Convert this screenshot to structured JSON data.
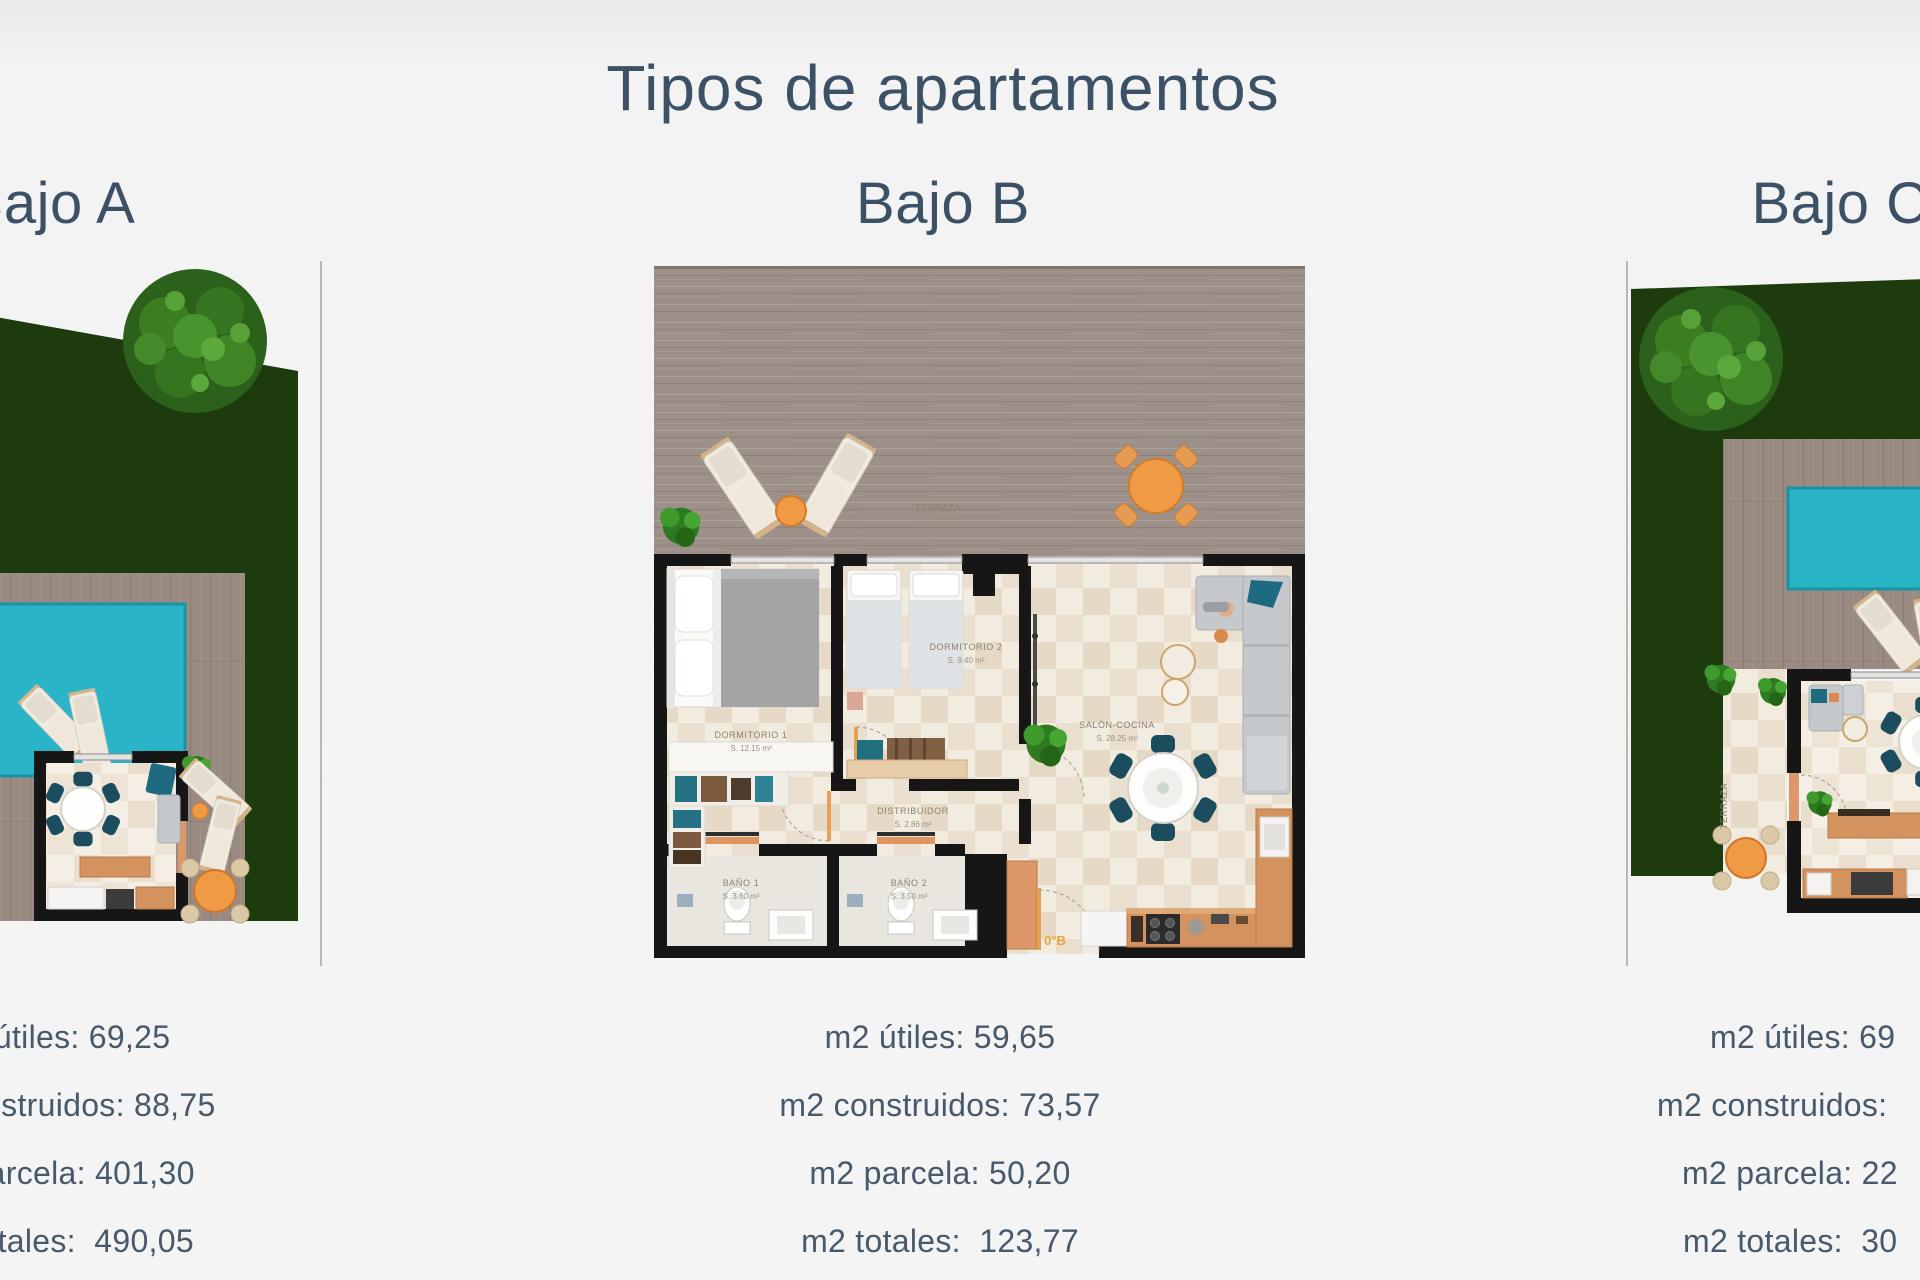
{
  "page": {
    "title": "Tipos de apartamentos"
  },
  "apartments": [
    {
      "id": "bajo-a",
      "title": "Bajo A",
      "stats": [
        "m2 útiles: 69,25",
        "m2 construidos: 88,75",
        "m2 parcela: 401,30",
        "m2 totales:  490,05"
      ]
    },
    {
      "id": "bajo-b",
      "title": "Bajo B",
      "stats": [
        "m2 útiles: 59,65",
        "m2 construidos: 73,57",
        "m2 parcela: 50,20",
        "m2 totales:  123,77"
      ],
      "plan_labels": {
        "terraza": "TERRAZA",
        "terraza_area": "S. 10.20 m²",
        "dormitorio1": "DORMITORIO 1",
        "dormitorio1_area": "S. 12.15 m²",
        "dormitorio2": "DORMITORIO 2",
        "dormitorio2_area": "S. 9.40 m²",
        "salon": "SALÓN-COCINA",
        "salon_area": "S. 28.25 m²",
        "distribuidor": "DISTRIBUIDOR",
        "distribuidor_area": "S. 2.86 m²",
        "bano1": "BAÑO 1",
        "bano1_area": "S. 3.60 m²",
        "bano2": "BAÑO 2",
        "bano2_area": "S. 3.50 m²",
        "puerta": "0°B"
      }
    },
    {
      "id": "bajo-c",
      "title": "Bajo C",
      "stats_visible": [
        "m2 útiles: 69",
        "m2 construidos:",
        "m2 parcela: 22",
        "m2 totales:  30"
      ],
      "plan_labels": {
        "terraza": "TERRAZA"
      }
    }
  ],
  "colors": {
    "heading_text": "#3d5166",
    "stats_text": "#48596b",
    "garden_green": "#1d3b0d",
    "pool_teal": "#29b4c8",
    "deck_wood": "#9c9088",
    "wall_black": "#161616",
    "kitchen_wood": "#d3925e",
    "accent_orange": "#f09a46",
    "plan_label_text": "#8c8172",
    "door_label_orange": "#f0a434"
  }
}
